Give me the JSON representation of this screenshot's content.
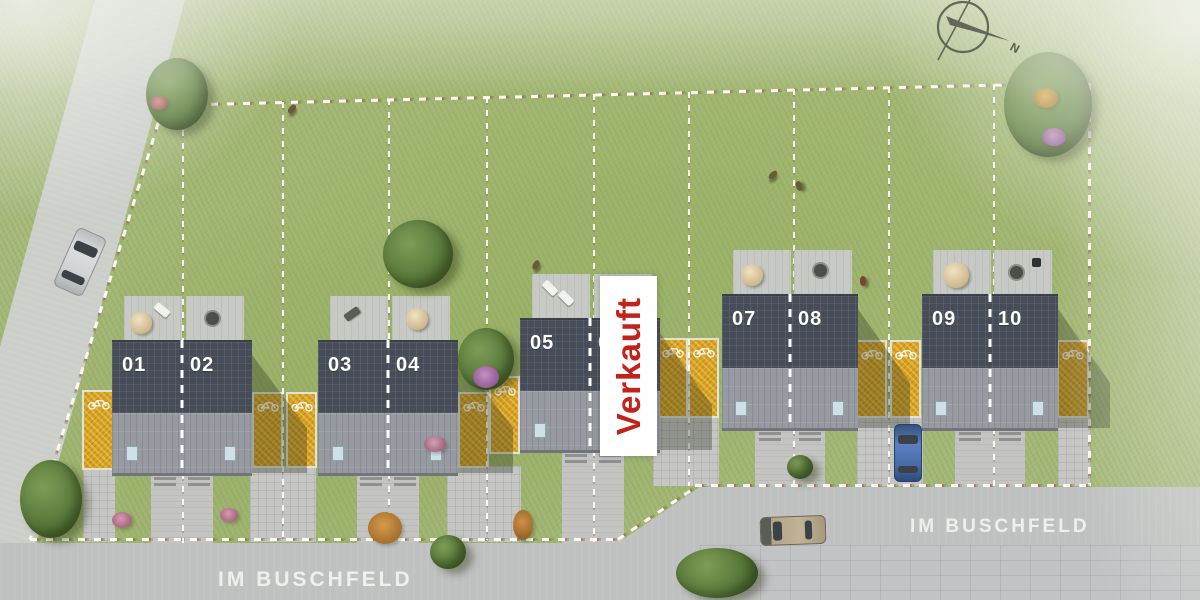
{
  "scene": {
    "title": "Lageplan Wohngebiet",
    "sold_label": "Verkauft",
    "street_label_left": "IM BUSCHFELD",
    "street_label_right": "IM BUSCHFELD",
    "compass_north": "N"
  },
  "plots": {
    "total": 10,
    "sold_unit": "06",
    "buildings": [
      {
        "units": [
          {
            "number": "01"
          },
          {
            "number": "02"
          }
        ]
      },
      {
        "units": [
          {
            "number": "03"
          },
          {
            "number": "04"
          }
        ]
      },
      {
        "units": [
          {
            "number": "05"
          },
          {
            "number": "06"
          }
        ]
      },
      {
        "units": [
          {
            "number": "07"
          },
          {
            "number": "08"
          }
        ]
      },
      {
        "units": [
          {
            "number": "09"
          },
          {
            "number": "10"
          }
        ]
      }
    ]
  },
  "colors": {
    "grass": "#a7ba7c",
    "road": "#bfc1c1",
    "roof_solar": "#474d58",
    "roof_lower": "#979aa1",
    "gravel": "#d8a11f",
    "sold_red": "#c2221c",
    "boundary_dash": "#fbfbf3",
    "label_text": "#f2f2ef"
  }
}
